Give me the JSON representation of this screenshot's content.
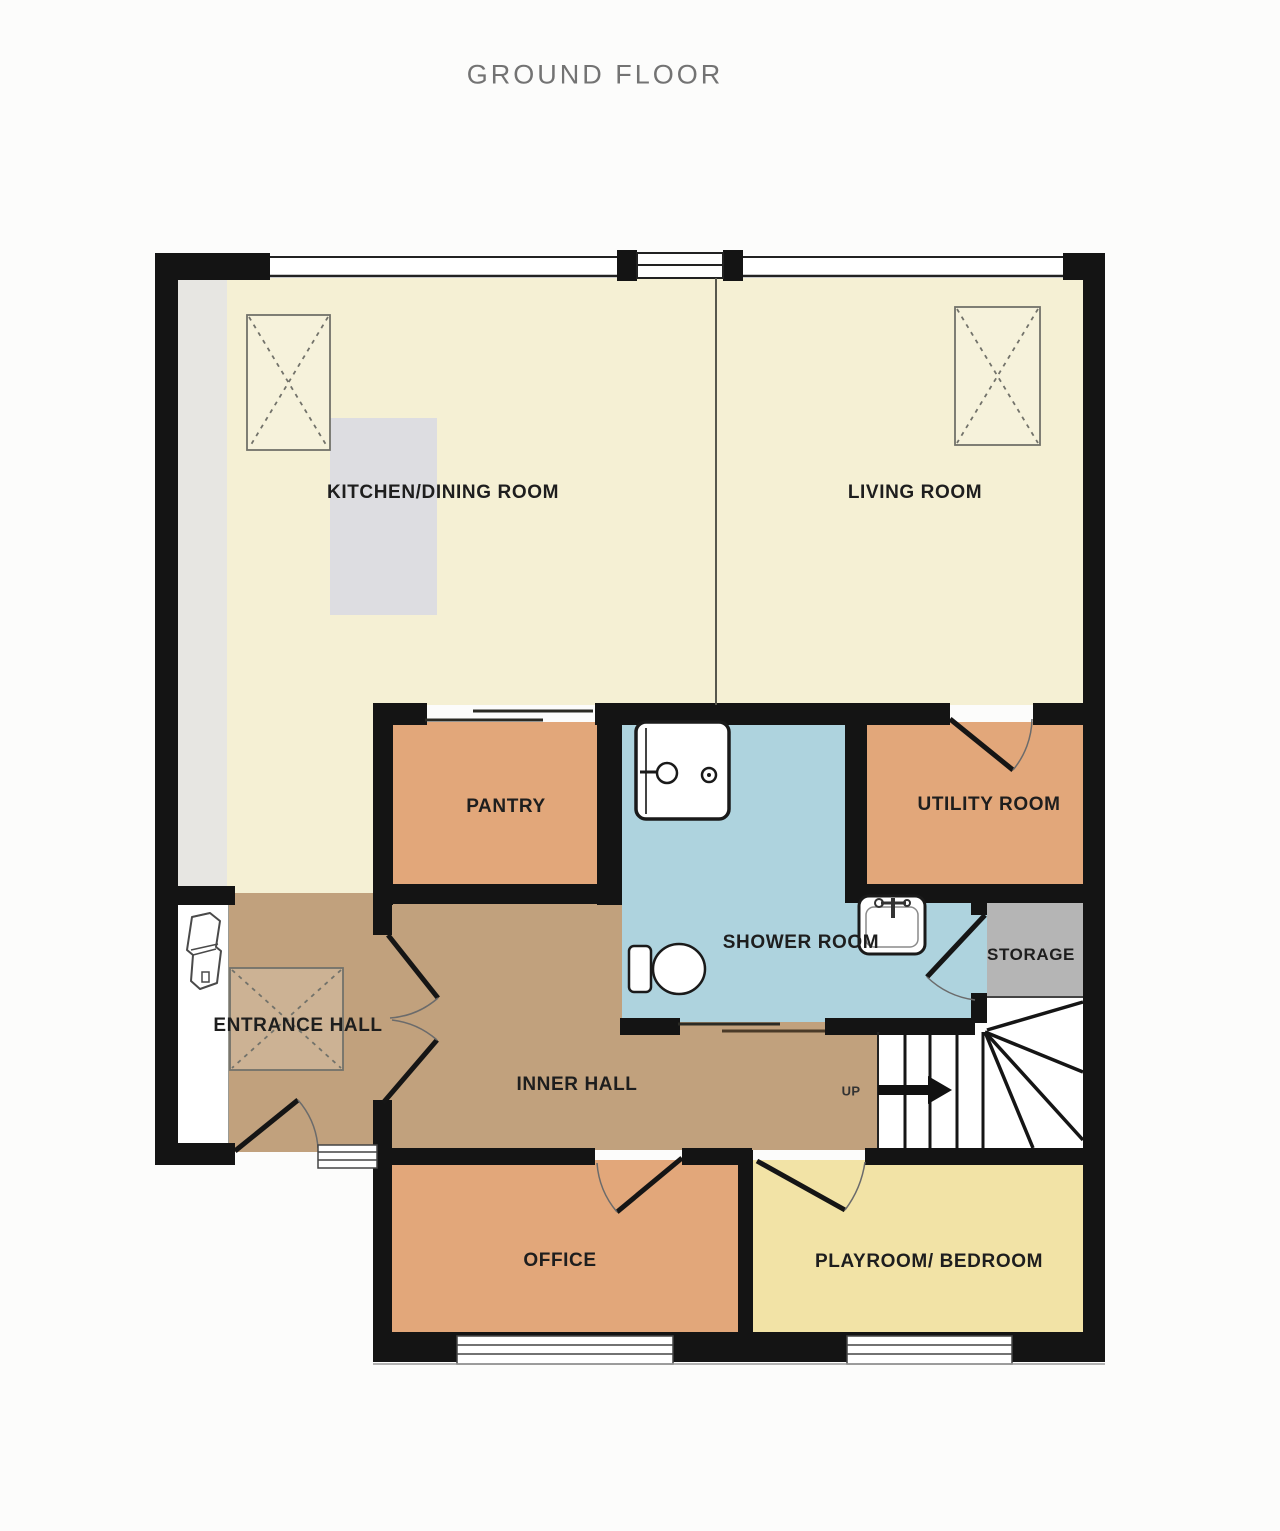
{
  "title": "GROUND FLOOR",
  "rooms": {
    "kitchen": {
      "label": "KITCHEN/DINING ROOM"
    },
    "living": {
      "label": "LIVING ROOM"
    },
    "pantry": {
      "label": "PANTRY"
    },
    "shower": {
      "label": "SHOWER ROOM"
    },
    "utility": {
      "label": "UTILITY ROOM"
    },
    "storage": {
      "label": "STORAGE"
    },
    "entrance": {
      "label": "ENTRANCE HALL"
    },
    "inner": {
      "label": "INNER HALL"
    },
    "office": {
      "label": "OFFICE"
    },
    "playroom": {
      "label": "PLAYROOM/ BEDROOM"
    }
  },
  "stairs": {
    "direction_label": "UP"
  },
  "colors": {
    "page_bg": "#fcfcfb",
    "wall": "#141414",
    "cream": "#f5f0d4",
    "orange": "#e2a77a",
    "yellow": "#f2e3a6",
    "blue": "#aed3de",
    "tan": "#c1a17d",
    "storage_gray": "#b5b5b5",
    "counter_gray": "#e7e6e2",
    "island_gray": "#dddde1",
    "label": "#1e1e1e",
    "title": "#737373"
  }
}
